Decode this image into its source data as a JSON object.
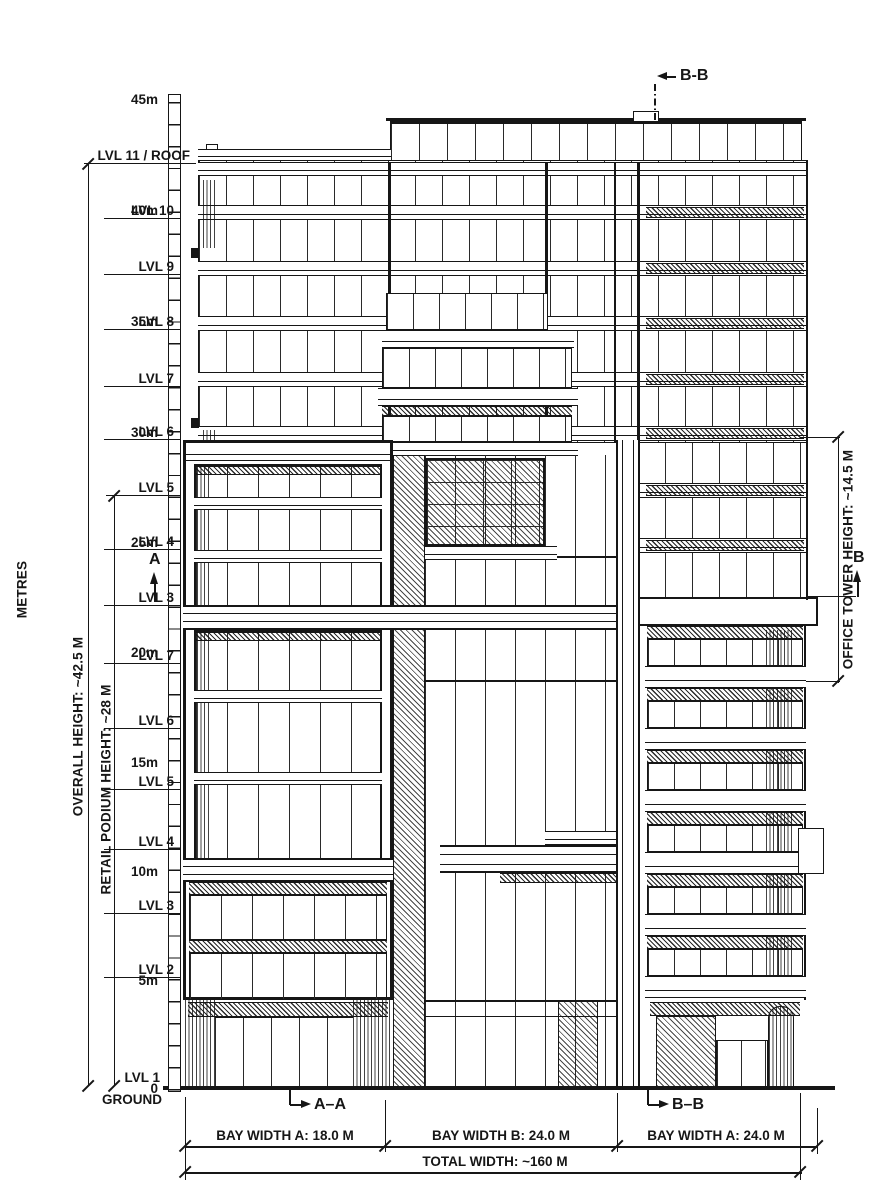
{
  "drawing": {
    "scale": {
      "unit_label": "METRES",
      "tick_labels": [
        "45m",
        "40m",
        "35m",
        "30m",
        "25m",
        "20m",
        "15m",
        "10m",
        "5m",
        "0"
      ]
    },
    "levels": [
      {
        "label": "LVL 11 / ROOF"
      },
      {
        "label": "LVL 10"
      },
      {
        "label": "LVL 9"
      },
      {
        "label": "LVL 8"
      },
      {
        "label": "LVL 7"
      },
      {
        "label": "LVL 6"
      },
      {
        "label": "LVL 5"
      },
      {
        "label": "LVL 4"
      },
      {
        "label": "LVL 3"
      },
      {
        "label": "LVL 7"
      },
      {
        "label": "LVL 6"
      },
      {
        "label": "LVL 5"
      },
      {
        "label": "LVL 4"
      },
      {
        "label": "LVL 3"
      },
      {
        "label": "LVL 2"
      },
      {
        "label": "LVL 1"
      },
      {
        "label": "GROUND"
      }
    ],
    "dimensions": {
      "overall_height": "OVERALL HEIGHT: ~42.5 M",
      "retail_podium_height": "RETAIL PODIUM HEIGHT: ~28 M",
      "office_tower_height": "OFFICE TOWER HEIGHT: ~14.5 M",
      "bay_widths": [
        "BAY WIDTH A: 18.0 M",
        "BAY WIDTH B: 24.0 M",
        "BAY WIDTH A: 24.0 M"
      ],
      "total_width": "TOTAL WIDTH: ~160 M"
    },
    "section_markers": {
      "top": "B-B",
      "elev_left": "A",
      "elev_right": "B",
      "bottom_left": "A–A",
      "bottom_right": "B–B"
    },
    "colors": {
      "ink": "#161616",
      "paper": "#ffffff"
    }
  }
}
